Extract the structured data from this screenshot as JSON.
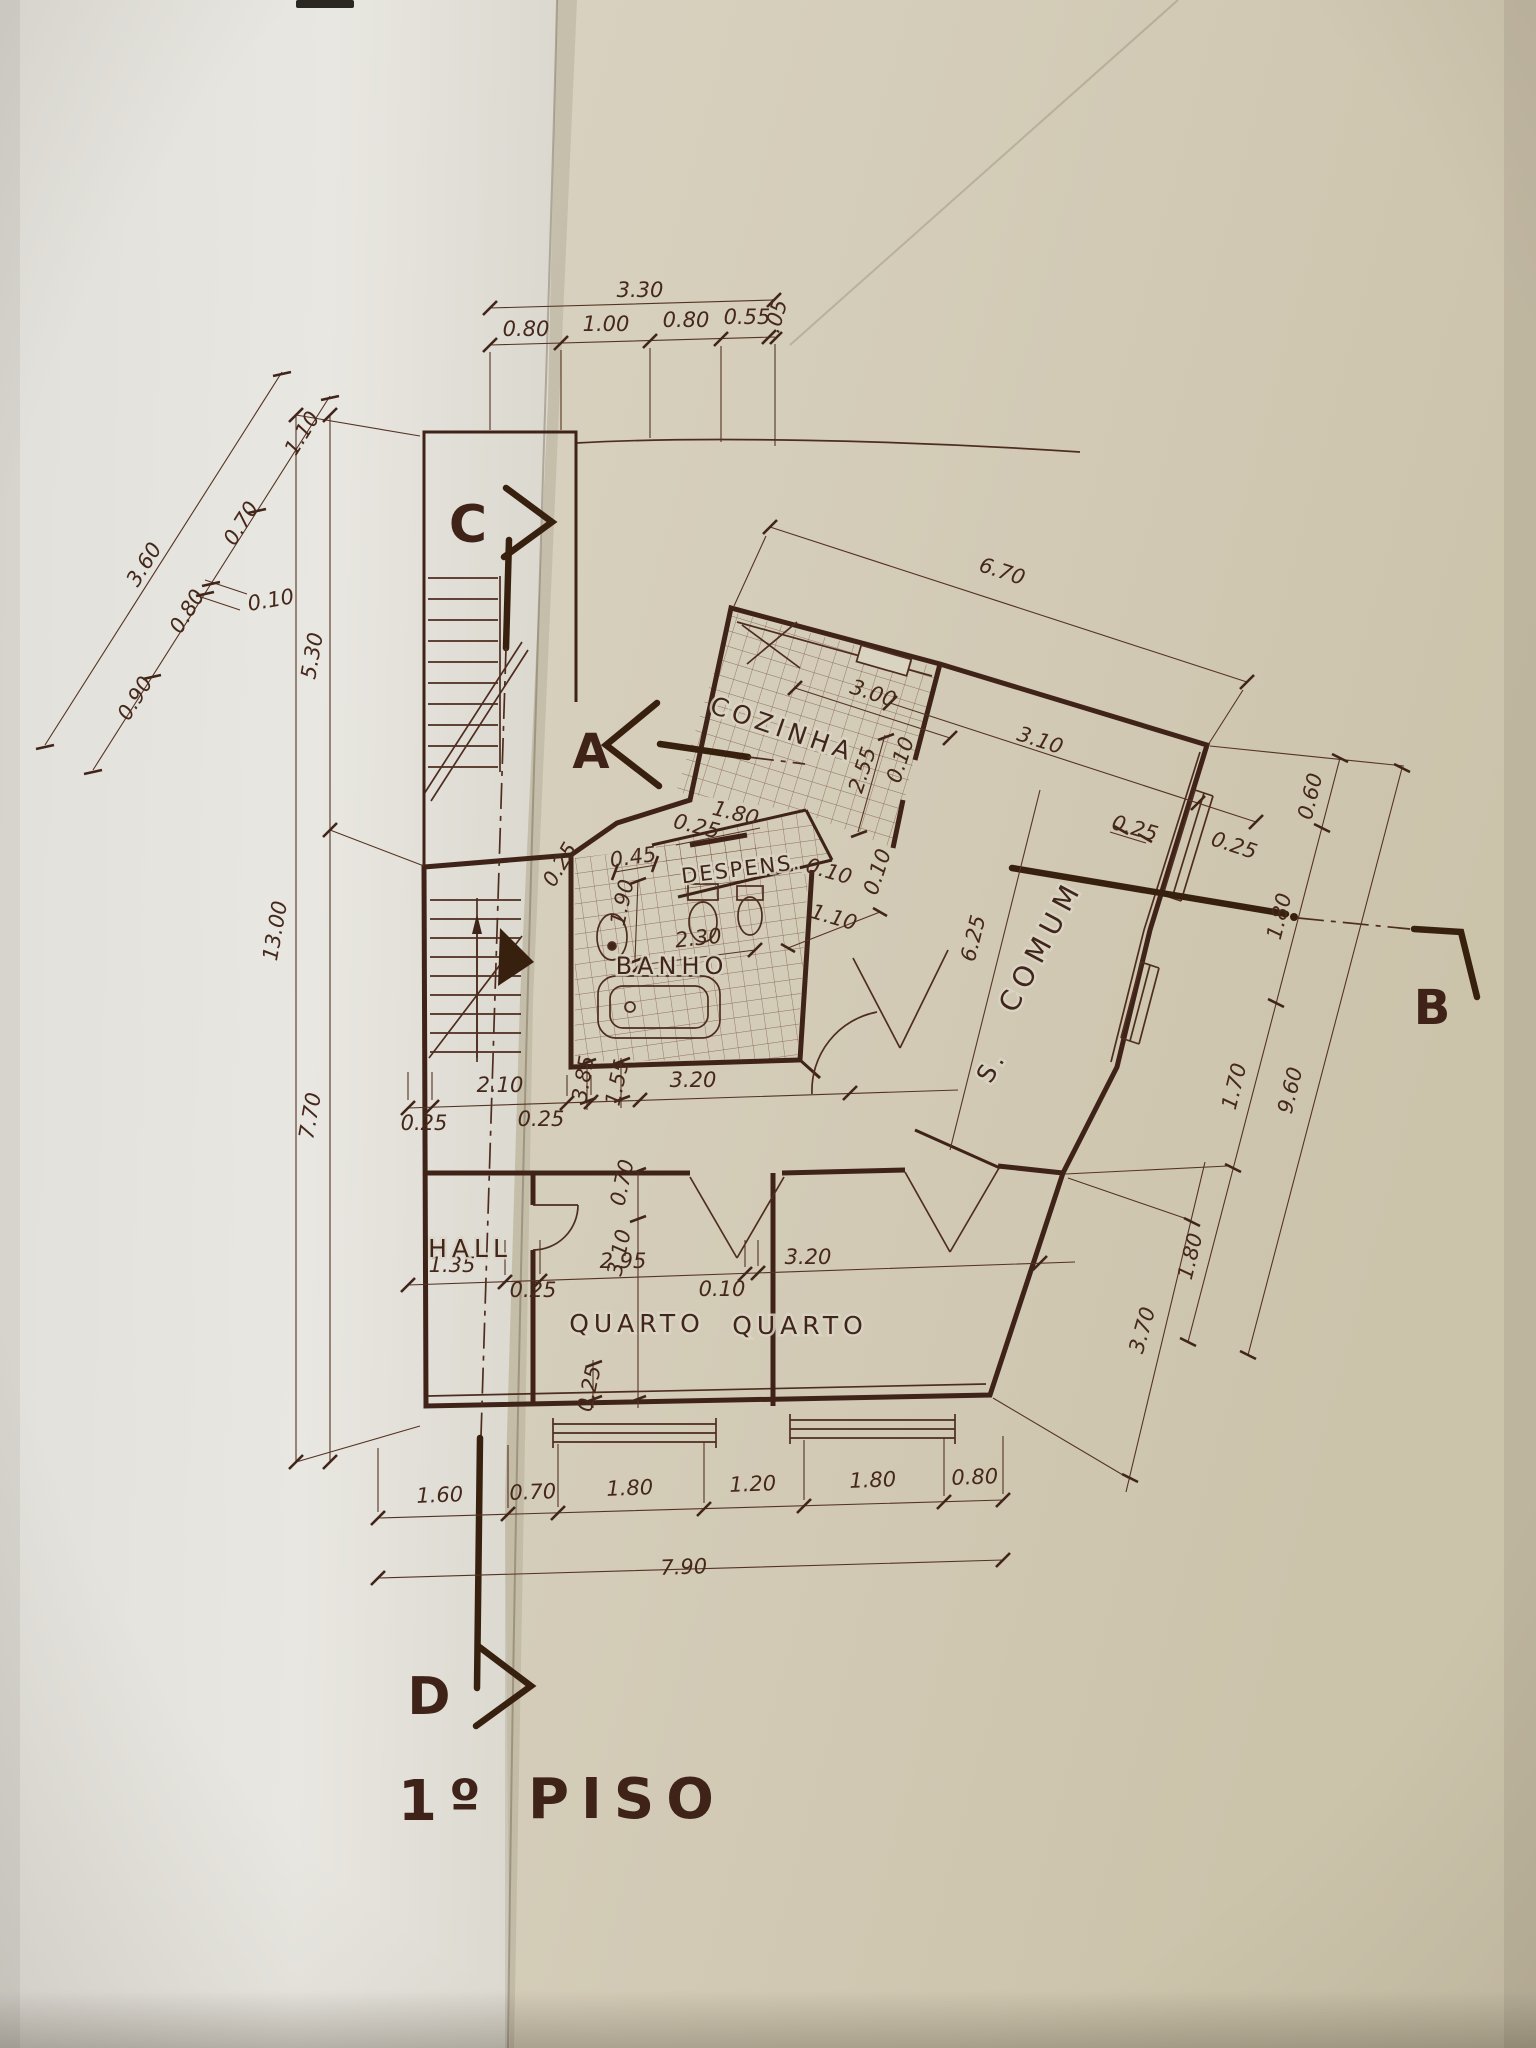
{
  "meta": {
    "drawing_type": "hand-drawn architectural floor plan on folded paper",
    "ink_color": "#46281b",
    "paper_left_color": "#e7e5df",
    "paper_right_color": "#d6cfbd"
  },
  "title": {
    "number": "1º",
    "word": "PISO"
  },
  "section_markers": {
    "a": "A",
    "b": "B",
    "c": "C",
    "d": "D"
  },
  "rooms": {
    "cozinha": "COZINHA",
    "despensa": "DESPENS.",
    "banho": "BANHO",
    "sala_s": "S.",
    "sala_comum": "COMUM",
    "hall": "HALL",
    "quarto_1": "QUARTO",
    "quarto_2": "QUARTO"
  },
  "dims": {
    "top": {
      "total": "3.30",
      "s1": "0.80",
      "s2": "1.00",
      "s3": "0.80",
      "s4": "0.55",
      "s5": ".05"
    },
    "left_slant": {
      "total": "3.60",
      "s1": "1.10",
      "s2": "0.70",
      "s3": "0.10",
      "s4": "0.80",
      "s5": "0.90"
    },
    "left_vert": {
      "total": "13.00",
      "upper": "5.30",
      "lower": "7.70"
    },
    "top_right": {
      "total": "6.70",
      "s1": "3.10",
      "s2": "0.25"
    },
    "kitchen": {
      "w": "3.00",
      "depth": "2.55",
      "wall": "0.10",
      "door": "1.80",
      "w2": "0.25",
      "desp": "0.45",
      "wall2": "0.10"
    },
    "bath": {
      "left": "0.25",
      "basin": "1.90",
      "w": "2.30",
      "s1": "1.10",
      "s2": "0.10",
      "v1": "3.85",
      "v2": "1.55"
    },
    "comum": {
      "len": "6.25",
      "wall": "0.25"
    },
    "right": {
      "s1": "0.60",
      "s2": "1.80",
      "s3": "1.70",
      "s4": "1.80",
      "total": "9.60",
      "lower": "3.70"
    },
    "mid": {
      "w1": "0.25",
      "hall": "2.10",
      "w2": "0.25",
      "corr": "3.20"
    },
    "bedrooms": {
      "hall": "1.35",
      "w1": "0.25",
      "q1": "2.95",
      "w2": "0.10",
      "q2": "3.20",
      "w3": "0.25",
      "v1": "0.70",
      "v2": "3.10"
    },
    "bottom": {
      "s1": "1.60",
      "s2": "0.70",
      "s3": "1.80",
      "s4": "1.20",
      "s5": "1.80",
      "s6": "0.80",
      "total": "7.90"
    }
  }
}
